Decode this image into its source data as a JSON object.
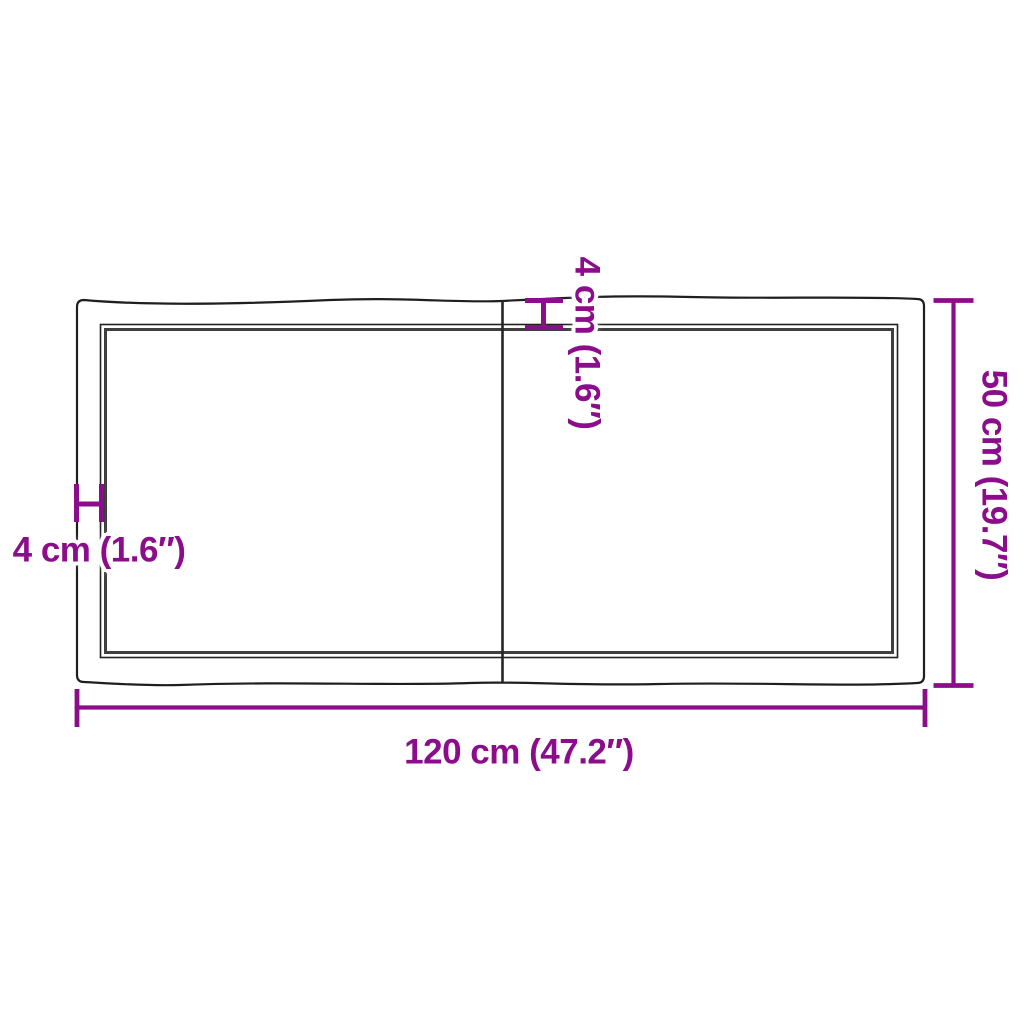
{
  "diagram": {
    "kind": "product-dimension-drawing",
    "subject": "tabletop-top-view-two-boards-live-edge",
    "colors": {
      "background": "#FFFFFF",
      "dimension_accent": "#8B0D8B",
      "outer_outline": "#1F1F1F",
      "inner_edge_thick": "#3F3F3F",
      "seam": "#262626"
    },
    "labels": {
      "width": "120 cm (47.2″)",
      "depth": "50 cm (19.7″)",
      "left_edge": "4 cm (1.6″)",
      "top_edge": "4 cm (1.6″)"
    },
    "values": {
      "width_cm": 120,
      "width_in": 47.2,
      "depth_cm": 50,
      "depth_in": 19.7,
      "edge_cm": 4,
      "edge_in": 1.6
    }
  }
}
